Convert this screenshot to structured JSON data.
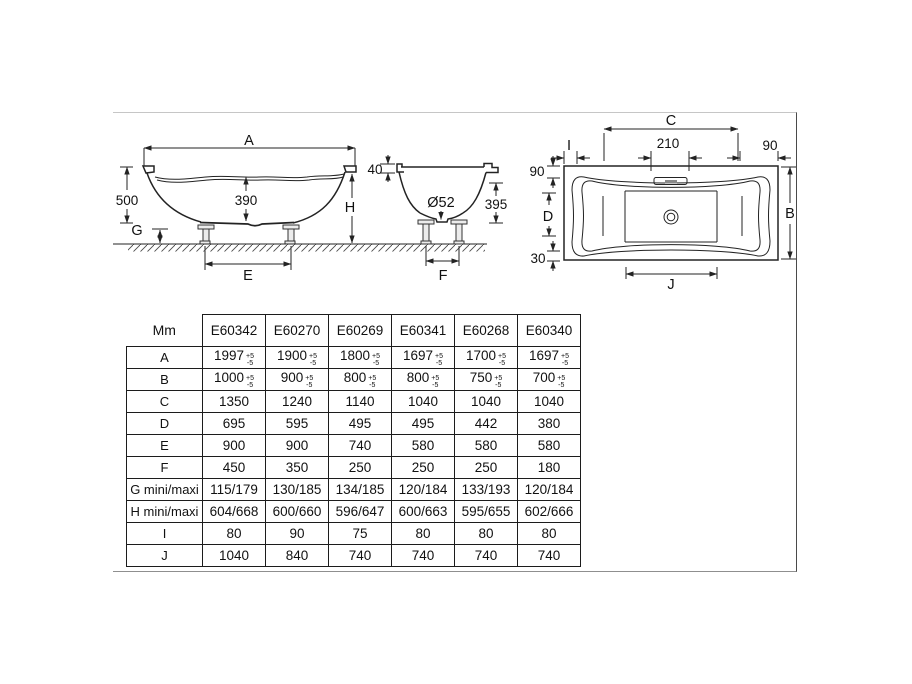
{
  "colors": {
    "background": "#ffffff",
    "line": "#232323",
    "frame_border": "#8f8f8f"
  },
  "diagram": {
    "side_view": {
      "length_label": "A",
      "total_height": "500",
      "water_depth": "390",
      "foot_height": "G",
      "feet_spacing": "E",
      "height_to_floor": "H"
    },
    "section_view": {
      "rim_thickness": "40",
      "drain_diameter": "Ø52",
      "inner_depth": "395",
      "feet_spacing": "F"
    },
    "plan_view": {
      "rim_length": "C",
      "overflow_width": "210",
      "rim_width_right": "90",
      "corner_left": "I",
      "rim_width_left": "90",
      "basin_width": "D",
      "rim_width_bottom": "30",
      "overall_width": "B",
      "basin_length": "J"
    }
  },
  "table": {
    "unit_label": "Mm",
    "products": [
      "E60342",
      "E60270",
      "E60269",
      "E60341",
      "E60268",
      "E60340"
    ],
    "rows": [
      {
        "label": "A",
        "values": [
          "1997",
          "1900",
          "1800",
          "1697",
          "1700",
          "1697"
        ],
        "tolerance": {
          "plus": "+5",
          "minus": "-5"
        }
      },
      {
        "label": "B",
        "values": [
          "1000",
          "900",
          "800",
          "800",
          "750",
          "700"
        ],
        "tolerance": {
          "plus": "+5",
          "minus": "-5"
        }
      },
      {
        "label": "C",
        "values": [
          "1350",
          "1240",
          "1140",
          "1040",
          "1040",
          "1040"
        ]
      },
      {
        "label": "D",
        "values": [
          "695",
          "595",
          "495",
          "495",
          "442",
          "380"
        ]
      },
      {
        "label": "E",
        "values": [
          "900",
          "900",
          "740",
          "580",
          "580",
          "580"
        ]
      },
      {
        "label": "F",
        "values": [
          "450",
          "350",
          "250",
          "250",
          "250",
          "180"
        ]
      },
      {
        "label": "G mini/maxi",
        "values": [
          "115/179",
          "130/185",
          "134/185",
          "120/184",
          "133/193",
          "120/184"
        ]
      },
      {
        "label": "H mini/maxi",
        "values": [
          "604/668",
          "600/660",
          "596/647",
          "600/663",
          "595/655",
          "602/666"
        ]
      },
      {
        "label": "I",
        "values": [
          "80",
          "90",
          "75",
          "80",
          "80",
          "80"
        ]
      },
      {
        "label": "J",
        "values": [
          "1040",
          "840",
          "740",
          "740",
          "740",
          "740"
        ]
      }
    ]
  }
}
